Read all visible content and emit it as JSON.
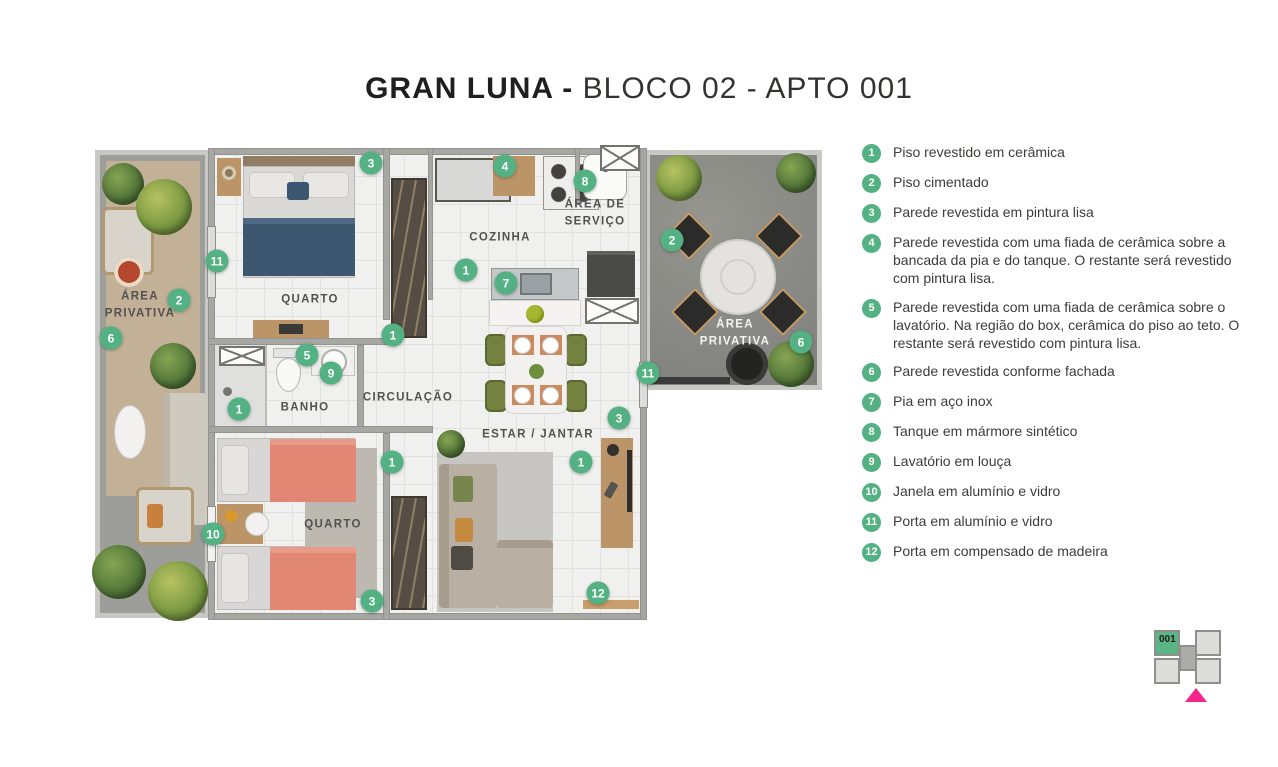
{
  "title": {
    "brand": "GRAN LUNA -",
    "unit": "BLOCO 02 - APTO 001"
  },
  "colors": {
    "marker_green": "#53b183",
    "keyplan_highlight": "#5cb586",
    "keyplan_arrow": "#f5258c",
    "title_text": "#1f1f1f"
  },
  "legend": {
    "items": [
      {
        "num": "1",
        "text": "Piso revestido em cerâmica"
      },
      {
        "num": "2",
        "text": "Piso cimentado"
      },
      {
        "num": "3",
        "text": "Parede revestida em pintura lisa"
      },
      {
        "num": "4",
        "text": "Parede revestida com uma fiada de cerâmica sobre a bancada da pia e do tanque. O restante será revestido com pintura lisa."
      },
      {
        "num": "5",
        "text": "Parede revestida com uma fiada de cerâmica sobre o lavatório. Na região do box, cerâmica do piso ao teto. O restante será revestido com pintura lisa."
      },
      {
        "num": "6",
        "text": "Parede revestida conforme fachada"
      },
      {
        "num": "7",
        "text": "Pia em aço inox"
      },
      {
        "num": "8",
        "text": "Tanque em mármore sintético"
      },
      {
        "num": "9",
        "text": "Lavatório em louça"
      },
      {
        "num": "10",
        "text": "Janela em alumínio e vidro"
      },
      {
        "num": "11",
        "text": "Porta em alumínio e vidro"
      },
      {
        "num": "12",
        "text": "Porta em compensado de madeira"
      }
    ]
  },
  "plan": {
    "room_labels": [
      {
        "text": "ÁREA\nPRIVATIVA",
        "x": 45,
        "y": 157,
        "theme": "dark"
      },
      {
        "text": "QUARTO",
        "x": 215,
        "y": 152,
        "theme": "dark"
      },
      {
        "text": "COZINHA",
        "x": 405,
        "y": 90,
        "theme": "dark"
      },
      {
        "text": "ÁREA DE\nSERVIÇO",
        "x": 500,
        "y": 65,
        "theme": "dark"
      },
      {
        "text": "BANHO",
        "x": 210,
        "y": 260,
        "theme": "dark"
      },
      {
        "text": "CIRCULAÇÃO",
        "x": 313,
        "y": 250,
        "theme": "dark"
      },
      {
        "text": "QUARTO",
        "x": 238,
        "y": 377,
        "theme": "dark"
      },
      {
        "text": "ESTAR / JANTAR",
        "x": 443,
        "y": 287,
        "theme": "dark"
      },
      {
        "text": "ÁREA\nPRIVATIVA",
        "x": 640,
        "y": 185,
        "theme": "light"
      }
    ],
    "markers": [
      {
        "n": "3",
        "x": 276,
        "y": 15
      },
      {
        "n": "4",
        "x": 410,
        "y": 18
      },
      {
        "n": "8",
        "x": 490,
        "y": 33
      },
      {
        "n": "2",
        "x": 577,
        "y": 92
      },
      {
        "n": "11",
        "x": 122,
        "y": 113
      },
      {
        "n": "1",
        "x": 371,
        "y": 122
      },
      {
        "n": "7",
        "x": 411,
        "y": 135
      },
      {
        "n": "2",
        "x": 84,
        "y": 152
      },
      {
        "n": "1",
        "x": 298,
        "y": 187
      },
      {
        "n": "6",
        "x": 16,
        "y": 190
      },
      {
        "n": "6",
        "x": 706,
        "y": 194
      },
      {
        "n": "5",
        "x": 212,
        "y": 207
      },
      {
        "n": "9",
        "x": 236,
        "y": 225
      },
      {
        "n": "11",
        "x": 553,
        "y": 225
      },
      {
        "n": "1",
        "x": 144,
        "y": 261
      },
      {
        "n": "3",
        "x": 524,
        "y": 270
      },
      {
        "n": "1",
        "x": 297,
        "y": 314
      },
      {
        "n": "1",
        "x": 486,
        "y": 314
      },
      {
        "n": "10",
        "x": 118,
        "y": 386
      },
      {
        "n": "3",
        "x": 277,
        "y": 453
      },
      {
        "n": "12",
        "x": 503,
        "y": 445
      }
    ]
  },
  "keyplan": {
    "unit_label": "001"
  }
}
